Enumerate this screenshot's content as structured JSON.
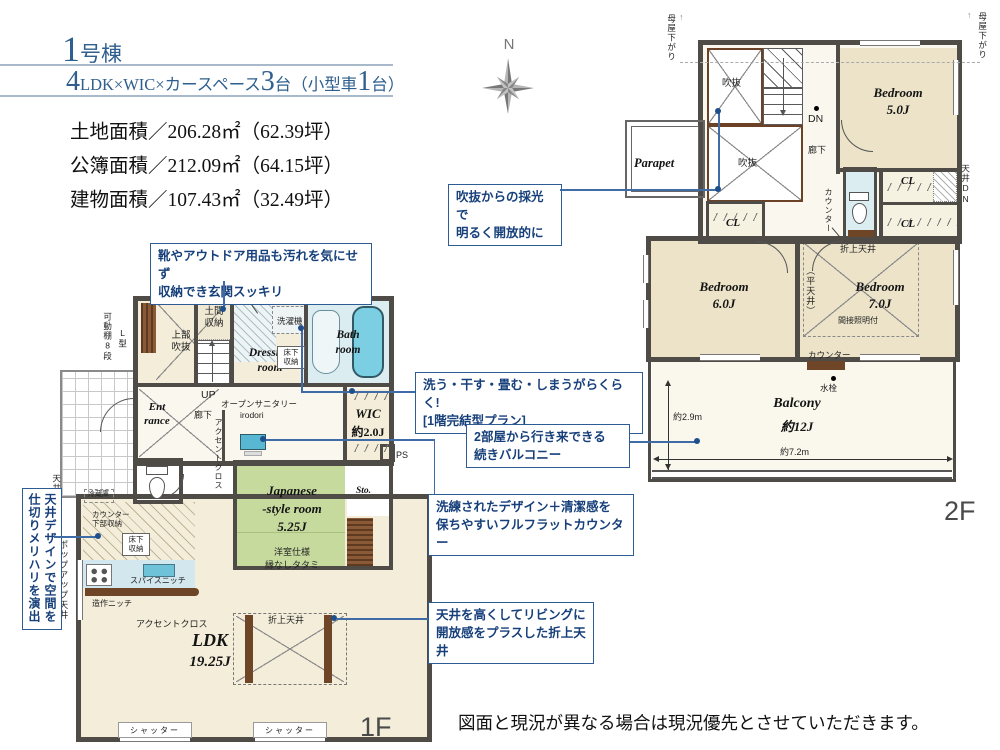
{
  "header": {
    "unit_big": "1",
    "unit_small": "号棟",
    "subtitle": {
      "p1": "4",
      "p2": "LDK×WIC×カースペース",
      "p3": "3",
      "p4": "台（小型車",
      "p5": "1",
      "p6": "台）"
    },
    "areas": [
      "土地面積／206.28㎡（62.39坪）",
      "公簿面積／212.09㎡（64.15坪）",
      "建物面積／107.43㎡（32.49坪）"
    ]
  },
  "compass": {
    "north": "N"
  },
  "shared": {
    "cl": "CL",
    "tenjo_dn": "天井DN",
    "shutter": "シャッター",
    "jobu_fukinuke": "上部\n吹抜",
    "yukashita": "床下\n収納",
    "accent": "アクセントクロス",
    "moya": "母屋下がり",
    "fukinuke": "吹抜",
    "oriage": "折上天井",
    "counter": "カウンター"
  },
  "callouts": {
    "genkan": "靴やアウトドア用品も汚れを気にせず\n収納でき玄関スッキリ",
    "fukinuke": "吹抜からの採光で\n明るく開放的に",
    "laundry": "洗う・干す・畳む・しまうがらくらく!\n[1階完結型プラン]",
    "balcony": "2部屋から行き来できる\n続きバルコニー",
    "counter": "洗練されたデザイン＋清潔感を\n保ちやすいフルフラットカウンター",
    "oriage": "天井を高くしてリビングに\n開放感をプラスした折上天井",
    "ceiling_design": "天井デザインで空間を\n仕切りメリハリを演出"
  },
  "floor1": {
    "floor_label": "1F",
    "kadou": "可動棚8段",
    "lgata": "L型",
    "doma": "土間\n収納",
    "sentakuki": "洗濯機",
    "dressing": "Dressing\nroom",
    "bath": "Bath\nroom",
    "up": "UP",
    "entrance": "Ent\nrance",
    "rouka": "廊下",
    "open_sanitary": "オープンサニタリー",
    "irodori": "irodori",
    "wic_name": "WIC",
    "wic_size": "約2.0J",
    "ps": "PS",
    "japanese": "Japanese\n-style room\n5.25J",
    "yoshitsu": "洋室仕様",
    "tatami": "縁なしタタミ",
    "sto": "Sto.",
    "reizouko": "冷蔵庫",
    "counter_lower": "カウンター\n下部収納",
    "spice": "スパイスニッチ",
    "zosaku": "造作ニッチ",
    "ldk_name": "LDK",
    "ldk_size": "19.25J",
    "popup": "ポップアップ天井"
  },
  "floor2": {
    "floor_label": "2F",
    "dn": "DN",
    "rouka": "廊下",
    "bedroom5": "Bedroom\n5.0J",
    "parapet": "Parapet",
    "hira": "（平天井）",
    "bedroom7": "Bedroom\n7.0J",
    "kansetsu": "間接照明付",
    "bedroom6": "Bedroom\n6.0J",
    "suisen": "水栓",
    "balcony_name": "Balcony",
    "balcony_size": "約12J",
    "dim_v": "約2.9m",
    "dim_h": "約7.2m"
  },
  "disclaimer": "図面と現況が異なる場合は現況優先とさせていただきます。"
}
